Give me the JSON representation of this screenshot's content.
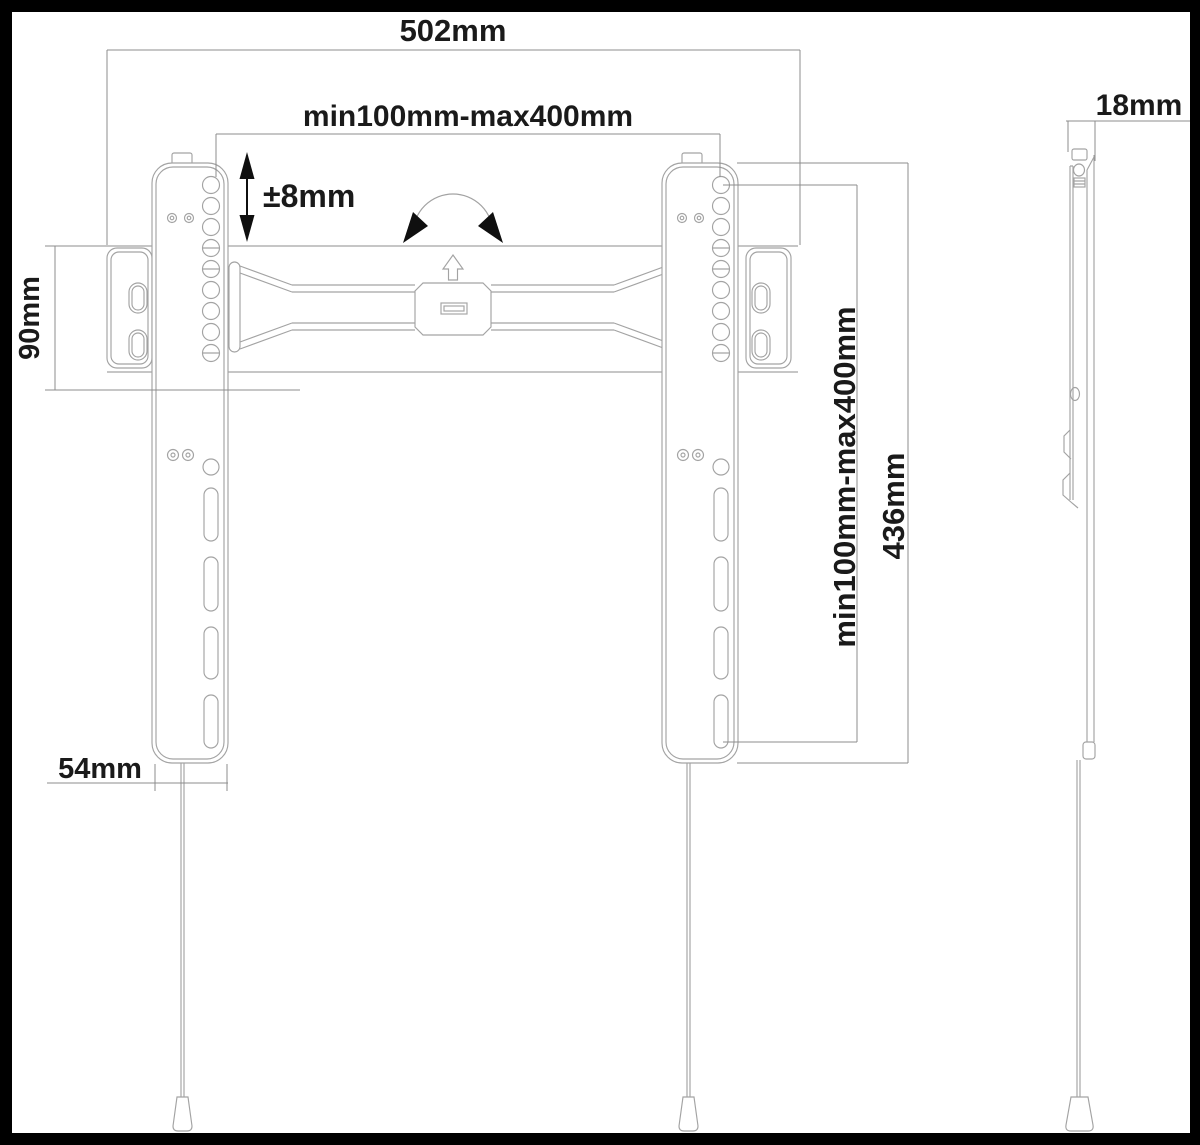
{
  "frame": {
    "background": "#000000",
    "paper": "#ffffff"
  },
  "drawing": {
    "part_line_color": "#a3a3a3",
    "dimension_line_color": "#8c8c8c",
    "text_color": "#1a1a1a"
  },
  "dimensions": {
    "total_width": "502mm",
    "vesa_horizontal_range": "min100mm-max400mm",
    "vertical_adjustment": "±8mm",
    "wall_rail_height": "90mm",
    "vesa_vertical_range": "min100mm-max400mm",
    "bracket_height": "436mm",
    "bracket_width": "54mm",
    "profile_depth": "18mm"
  }
}
